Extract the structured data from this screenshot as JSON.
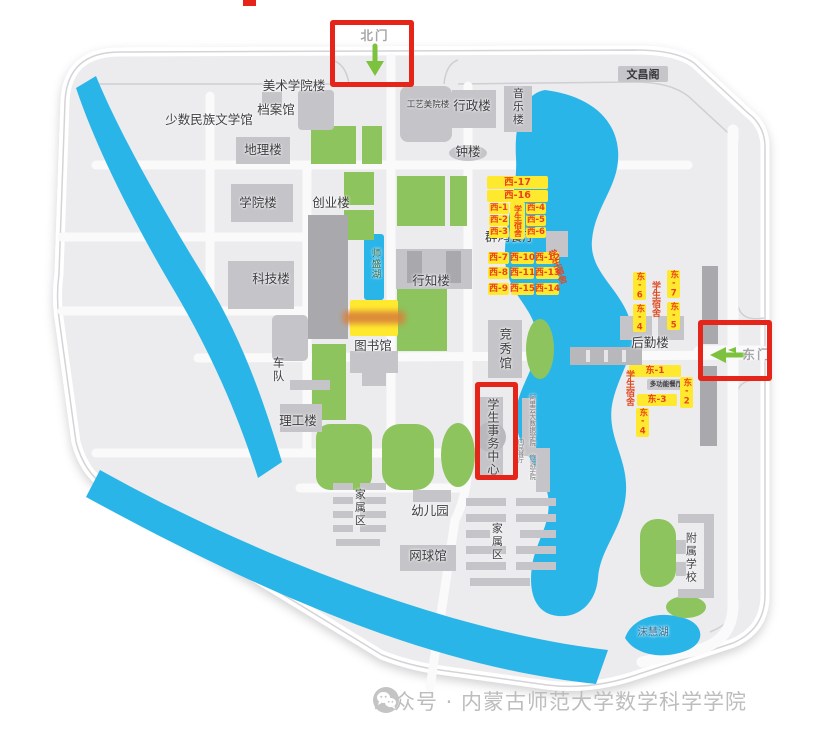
{
  "gates": {
    "north": "北门",
    "east": "东门"
  },
  "buildings": {
    "wenchang_pavilion": "文昌阁",
    "art_college": "美术学院楼",
    "archives": "档案馆",
    "minority_literature_hall": "少数民族文学馆",
    "geography_bldg": "地理楼",
    "college_bldg": "学院楼",
    "entrepreneurship_bldg": "创业楼",
    "craft_art_academy_bldg": "工艺美院楼",
    "administration_bldg": "行政楼",
    "music_bldg": "音乐楼",
    "bell_tower": "钟楼",
    "science_tech_bldg": "科技楼",
    "xingzhi_bldg": "行知楼",
    "library": "图书馆",
    "qunhong_dining_hall": "群鸿餐厅",
    "jingxiu_gym": "竞秀馆",
    "logistics_bldg": "后勤楼",
    "multifunction_dining_hall": "多功能餐厅",
    "student_affairs_center": "学生事务中心",
    "aliyun_bigdata_college": "阿里云大数据学院",
    "huimin_dining_hall": "回民餐厅",
    "tourism_college": "旅游学院",
    "motor_pool": "车队",
    "ligong_bldg": "理工楼",
    "kindergarten": "幼儿园",
    "tennis_hall": "网球馆",
    "family_area_west": "家属区",
    "family_area_east": "家属区",
    "affiliated_school": "附属学校"
  },
  "lakes": {
    "shisheng_lake": "师盛湖",
    "mohui_lake": "沫慧湖"
  },
  "dorms": {
    "student_dorm": "学生宿舍",
    "west": {
      "w1": "西-1",
      "w2": "西-2",
      "w3": "西-3",
      "w4": "西-4",
      "w5": "西-5",
      "w6": "西-6",
      "w7": "西-7",
      "w8": "西-8",
      "w9": "西-9",
      "w10": "西-10",
      "w11": "西-11",
      "w12": "西-12",
      "w13": "西-13",
      "w14": "西-14",
      "w15": "西-15",
      "w16": "西-16",
      "w17": "西-17"
    },
    "east": {
      "e1": "东-1",
      "e2": "东-2",
      "e3": "东-3",
      "e4": "东-4",
      "e5": "东-5",
      "e6": "东-6",
      "e7": "东-7"
    }
  },
  "watermark": {
    "text": "公众号 · 内蒙古师范大学数学科学学院"
  },
  "colors": {
    "highlight_box_red": "#e5251a",
    "dorm_label_bg": "#ffe92e",
    "dorm_label_text": "#e8431c",
    "water_blue": "#2ab5e9",
    "green_space": "#8dc45d",
    "gate_arrow_green": "#7cc23e",
    "campus_ground": "#ececee"
  }
}
